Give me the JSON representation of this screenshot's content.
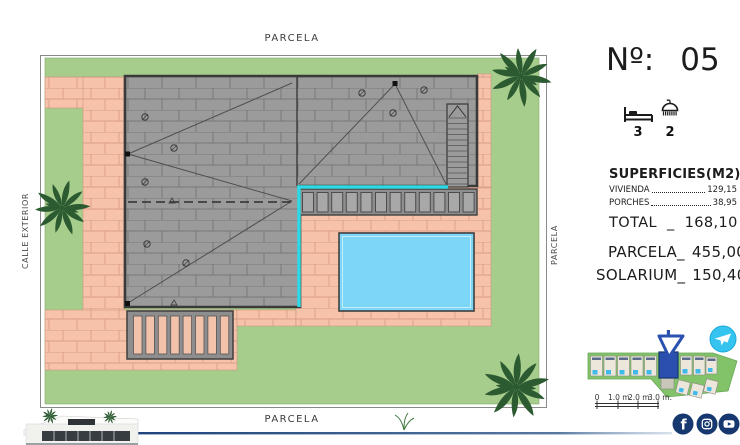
{
  "plan_labels": {
    "top": "PARCELA",
    "bottom": "PARCELA",
    "right": "PARCELA",
    "left": "CALLE EXTERIOR"
  },
  "header": {
    "number_label": "Nº:",
    "number_value": "05"
  },
  "features": {
    "bedrooms": "3",
    "bathrooms": "2"
  },
  "surfaces": {
    "title": "SUPERFICIES(M2)",
    "items": [
      {
        "label": "VIVIENDA",
        "value": "129,15"
      },
      {
        "label": "PORCHES",
        "value": "38,95"
      }
    ],
    "total_label": "TOTAL",
    "total_sep": "_",
    "total_value": "168,10"
  },
  "areas": {
    "parcela_label": "PARCELA_",
    "parcela_value": "455,00",
    "solarium_label": "SOLARIUM_",
    "solarium_value": "150,40"
  },
  "scalebar": {
    "t0": "0",
    "t1": "1.0 m.",
    "t2": "2.0 m.",
    "t3": "3.0 m."
  },
  "icons": {
    "facebook_glyph": "f"
  },
  "colors": {
    "lawn": "#a7cd8d",
    "path": "#f6c2a9",
    "roof": "#9b9b9b",
    "pool": "#7dd6f7",
    "gutter_cyan": "#2fd9e3",
    "navy": "#16386e",
    "brand_cyan": "#35c4ef",
    "palm": "#2c5a31",
    "plot_highlight": "#2b4fae"
  }
}
